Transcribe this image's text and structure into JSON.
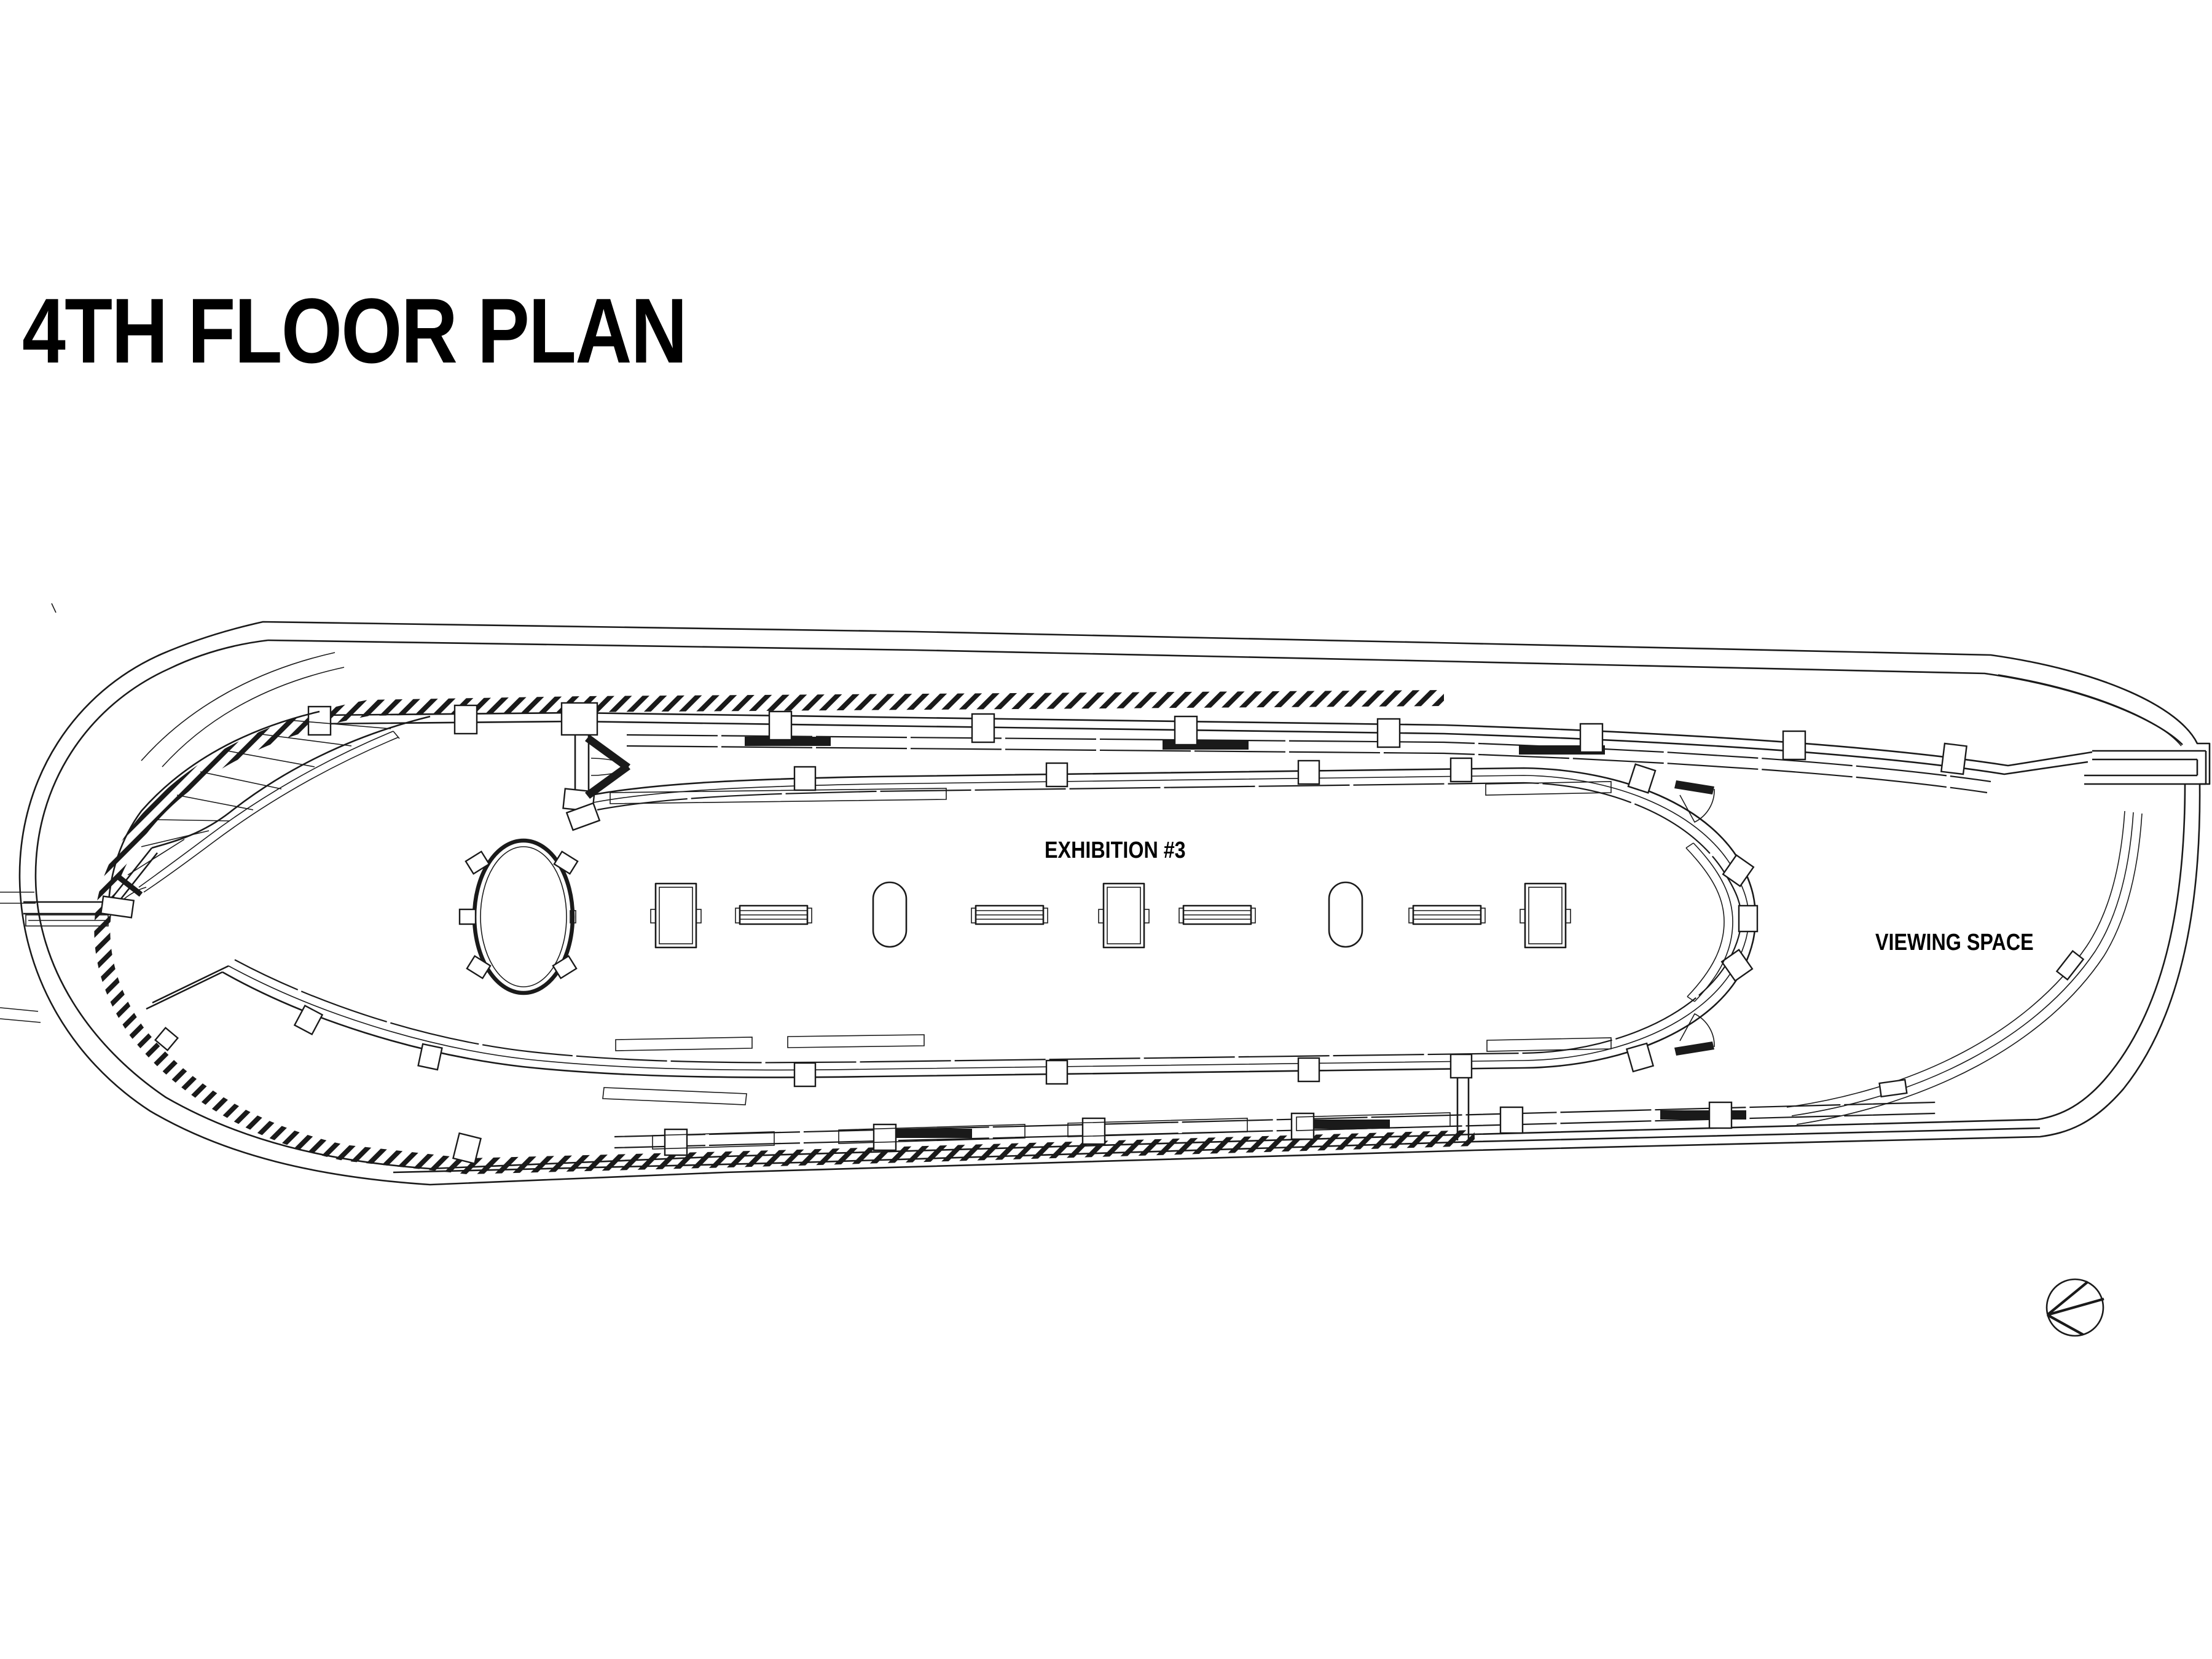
{
  "document": {
    "title": "4TH FLOOR PLAN",
    "type": "architectural floor plan drawing"
  },
  "plan": {
    "labels": {
      "exhibition": "EXHIBITION #3",
      "viewing": "VIEWING SPACE"
    },
    "symbols": {
      "north_arrow": "north-arrow-circle"
    },
    "colors": {
      "ink": "#1a1a1a",
      "paper": "#ffffff"
    }
  }
}
